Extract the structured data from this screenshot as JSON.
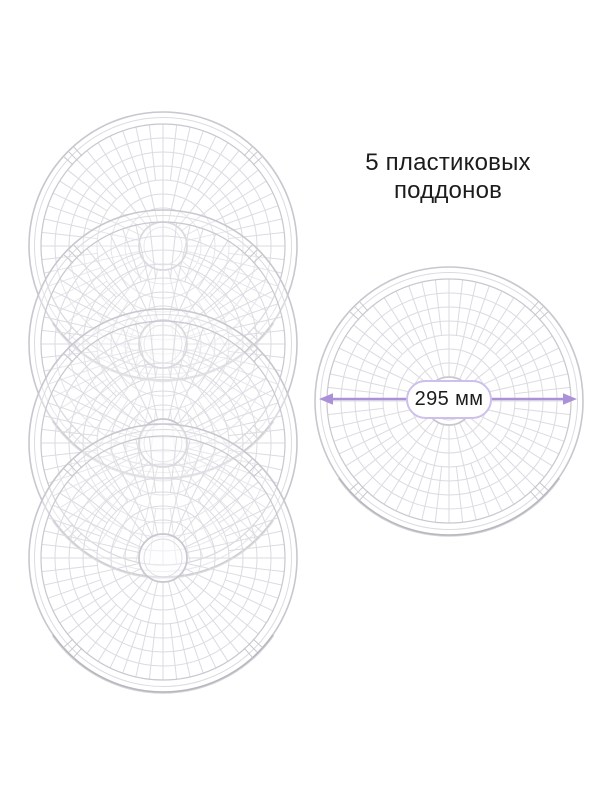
{
  "title": {
    "line1": "5 пластиковых",
    "line2": "поддонов",
    "full": "5 пластиковых поддонов"
  },
  "annotation": {
    "diameter_label": "295 мм"
  },
  "illustration": {
    "stacked_tray_count": 4,
    "measured_tray_count": 1
  },
  "colors": {
    "background": "#ffffff",
    "text": "#1c1c1c",
    "accent_purple": "#ab92d8",
    "pill_border": "#cec0ec",
    "tray_line": "#dbdbe1",
    "tray_rim": "#c7c7cf"
  }
}
